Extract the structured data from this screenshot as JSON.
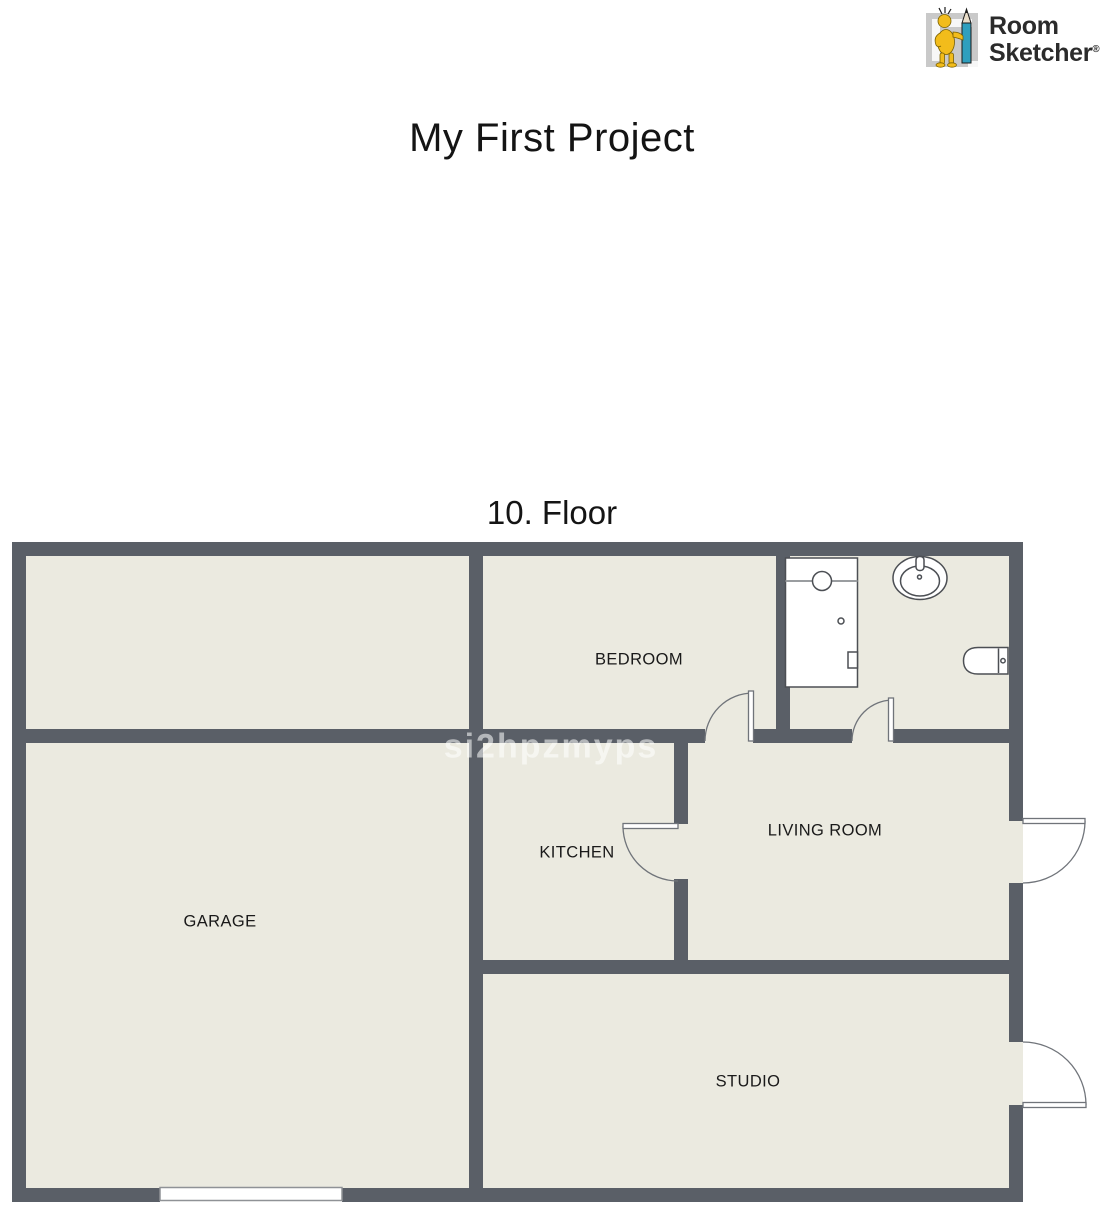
{
  "title": "My First Project",
  "floor": {
    "label": "10. Floor"
  },
  "watermark": "si2hpzmyps",
  "logo": {
    "name_line1": "Room",
    "name_line2": "Sketcher",
    "registered_mark": "®"
  },
  "rooms": {
    "bedroom": {
      "label": "BEDROOM"
    },
    "kitchen": {
      "label": "KITCHEN"
    },
    "living_room": {
      "label": "LIVING ROOM"
    },
    "garage": {
      "label": "GARAGE"
    },
    "studio": {
      "label": "STUDIO"
    }
  },
  "icons": {
    "shower": "shower-fixture-icon",
    "sink": "sink-fixture-icon",
    "toilet": "toilet-fixture-icon",
    "mascot": "roomsketcher-mascot-icon"
  },
  "colors": {
    "page_bg": "#ffffff",
    "wall": "#5a5f67",
    "floor": "#ebeae0",
    "fixture_stroke": "#4c4f54",
    "label_text": "#1a1a1a",
    "logo_text": "#2b2b2b",
    "logo_yellow": "#f2bc1b",
    "logo_blue": "#2f9fbe",
    "logo_gray": "#c9c9c9",
    "watermark_color": "rgba(255,255,255,0.55)"
  }
}
